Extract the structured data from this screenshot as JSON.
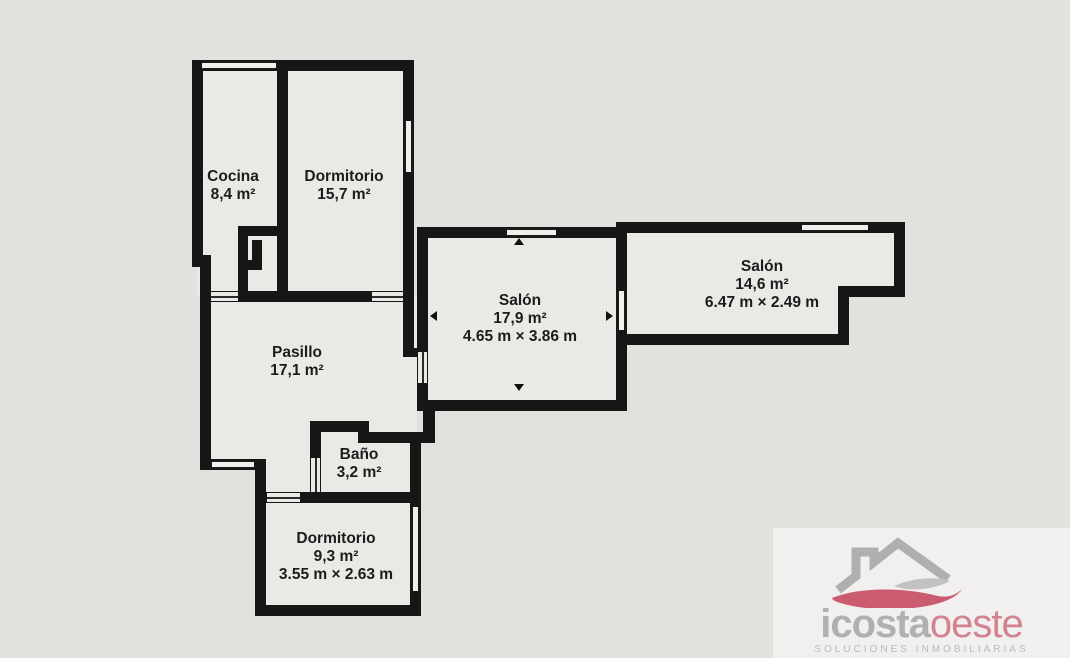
{
  "title": "Floor plan",
  "colors": {
    "background": "#e2e1de",
    "floor": "#eae9e6",
    "wall": "#161616",
    "label_text": "#1c1c1c",
    "logo_gray": "#b1b0ae",
    "logo_red": "#cb5b6e",
    "logo_tagline_gray": "#b7babd"
  },
  "rooms": [
    {
      "name": "Cocina",
      "area": "8,4 m²"
    },
    {
      "name": "Dormitorio",
      "area": "15,7 m²"
    },
    {
      "name": "Salón",
      "area": "17,9 m²",
      "dimensions": "4.65 m × 3.86 m"
    },
    {
      "name": "Salón",
      "area": "14,6 m²",
      "dimensions": "6.47 m × 2.49 m"
    },
    {
      "name": "Pasillo",
      "area": "17,1 m²"
    },
    {
      "name": "Baño",
      "area": "3,2 m²"
    },
    {
      "name": "Dormitorio",
      "area": "9,3 m²",
      "dimensions": "3.55 m × 2.63 m"
    }
  ],
  "logo": {
    "brand_primary": "icosta",
    "brand_secondary": "oeste",
    "tagline": "SOLUCIONES INMOBILIARIAS"
  }
}
